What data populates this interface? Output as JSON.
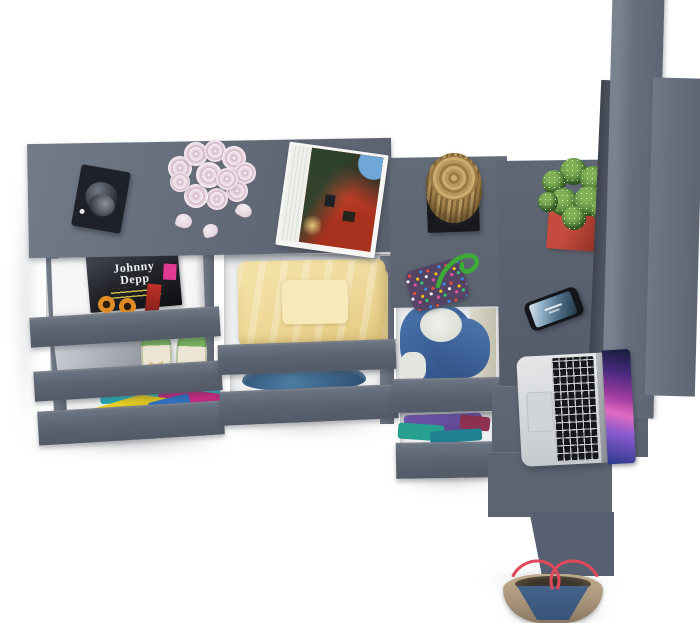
{
  "scene": {
    "description": "Top-down 3D render of an anthracite grey L-shaped dresser and desk unit with open drawers, styled with decor items, on a white floor",
    "floor_color": "#ffffff",
    "furniture": {
      "top_surface_color": "#68717f",
      "drawer_front_color": "#5b6371",
      "panel_color": "#636c7a",
      "drawer_interior_color": "#edeff0"
    }
  },
  "objects": {
    "valet_tray": {
      "label": "black tray with sunglasses",
      "color": "#1a1d24"
    },
    "rose_bouquet": {
      "label": "bouquet of pale pink roses with fallen petals",
      "color": "#ddc4d2",
      "petal_count": 3
    },
    "open_magazine": {
      "label": "open magazine showing a red building photo",
      "colors": [
        "#c04a30",
        "#2a422c",
        "#6fa8d8",
        "#f6f6f4"
      ]
    },
    "magazines_drawer": {
      "label": "drawer with magazine stack",
      "cover_title": "Johnny Depp",
      "cover_color": "#23252b",
      "sticker_color": "#e23a92",
      "graphic_color": "#e08c26"
    },
    "storage_box": {
      "label": "grey storage box",
      "color": "#aeb2ba"
    },
    "ballet_flats": {
      "label": "pair of green ballet flats with bows",
      "shoe_color": "#77b15d",
      "insole_color": "#ede5d3",
      "bow_color": "#d9c08e"
    },
    "colorful_clothes": {
      "label": "folded colorful clothes in bottom drawer",
      "colors": [
        "#2fbcc9",
        "#c22a7e",
        "#e0ca22",
        "#2f6fbd"
      ]
    },
    "yellow_blanket": {
      "label": "folded pale yellow blanket",
      "color": "#efd99c"
    },
    "blue_fabric": {
      "label": "folded steel blue garment",
      "color": "#3f6a92"
    },
    "wooden_stump": {
      "label": "decorative wooden stump on black stand",
      "wood_color": "#a8854c",
      "stand_color": "#17191d"
    },
    "beaded_pouch": {
      "label": "multicolor beaded pouch with green cord",
      "base_color": "#564465",
      "cord_color": "#3cab37"
    },
    "cactus": {
      "label": "cactus in red square pot",
      "plant_color": "#4f8238",
      "pot_color": "#b03a2e"
    },
    "smartphone": {
      "label": "smartphone with lit lock screen",
      "body_color": "#13151a",
      "screen_colors": [
        "#dbe7ee",
        "#53738c"
      ]
    },
    "laptop": {
      "label": "open silver laptop with purple galaxy wallpaper",
      "body_color": "#d8dadd",
      "key_color": "#16171b",
      "screen_colors": [
        "#131c3a",
        "#a23ba0",
        "#e06ac0",
        "#2a3a8a"
      ]
    },
    "blue_hoodie": {
      "label": "blue hoodie with fleece lining in tall drawer",
      "colors": [
        "#3e66a4",
        "#e9eae5",
        "#d2cfbf"
      ]
    },
    "purple_clothes": {
      "label": "folded purple, teal and maroon clothes",
      "colors": [
        "#6a4fa1",
        "#27a08f",
        "#8e3050"
      ]
    },
    "tote_bag": {
      "label": "canvas and denim tote bag with red straps",
      "colors": [
        "#b3a183",
        "#3e5a80",
        "#e0495a"
      ]
    }
  }
}
